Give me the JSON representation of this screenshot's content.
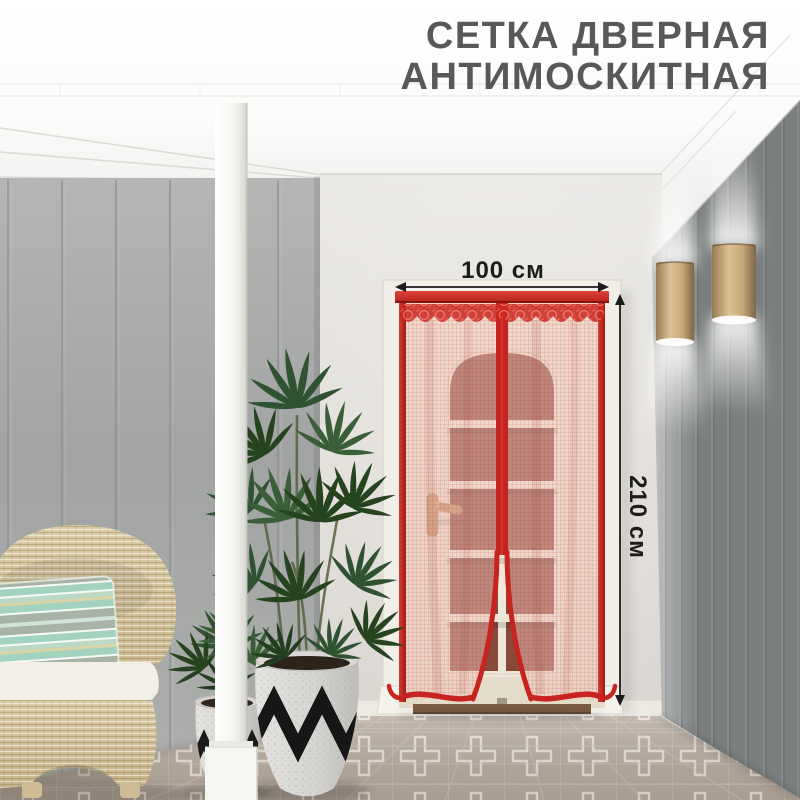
{
  "heading": {
    "line1": "СЕТКА ДВЕРНАЯ",
    "line2": "АНТИМОСКИТНАЯ"
  },
  "dimensions": {
    "width_label": "100 см",
    "height_label": "210 см"
  },
  "icons": {
    "width_arrow": "↔",
    "height_arrow": "↕"
  },
  "colors": {
    "accent_red": "#c8241f",
    "red_dark": "#a91d18",
    "mesh_pink": "#f2c7bf",
    "title_gray": "#58585a",
    "dim_black": "#1c1c1a",
    "wall_left": "#a8aaa9",
    "wall_back": "#e2dfdb",
    "wall_right": "#8d918f",
    "ceiling_white": "#f6f6f4",
    "floor_taupe": "#b6aa9e",
    "tile_line": "#e7e0d6",
    "pot_gray": "#d8d6d2",
    "zigzag_black": "#1a1a1a",
    "leaf_green": "#2f5231",
    "wicker_tan": "#d6c59e",
    "cushion_white": "#f2efe7",
    "pillow_mint": "#a3d2c0",
    "lamp_tan": "#cfb184",
    "door_cream": "#ece4d6",
    "pane_brown": "#87493a",
    "handle_brass": "#c49a66",
    "threshold_brown": "#7b5b43"
  }
}
